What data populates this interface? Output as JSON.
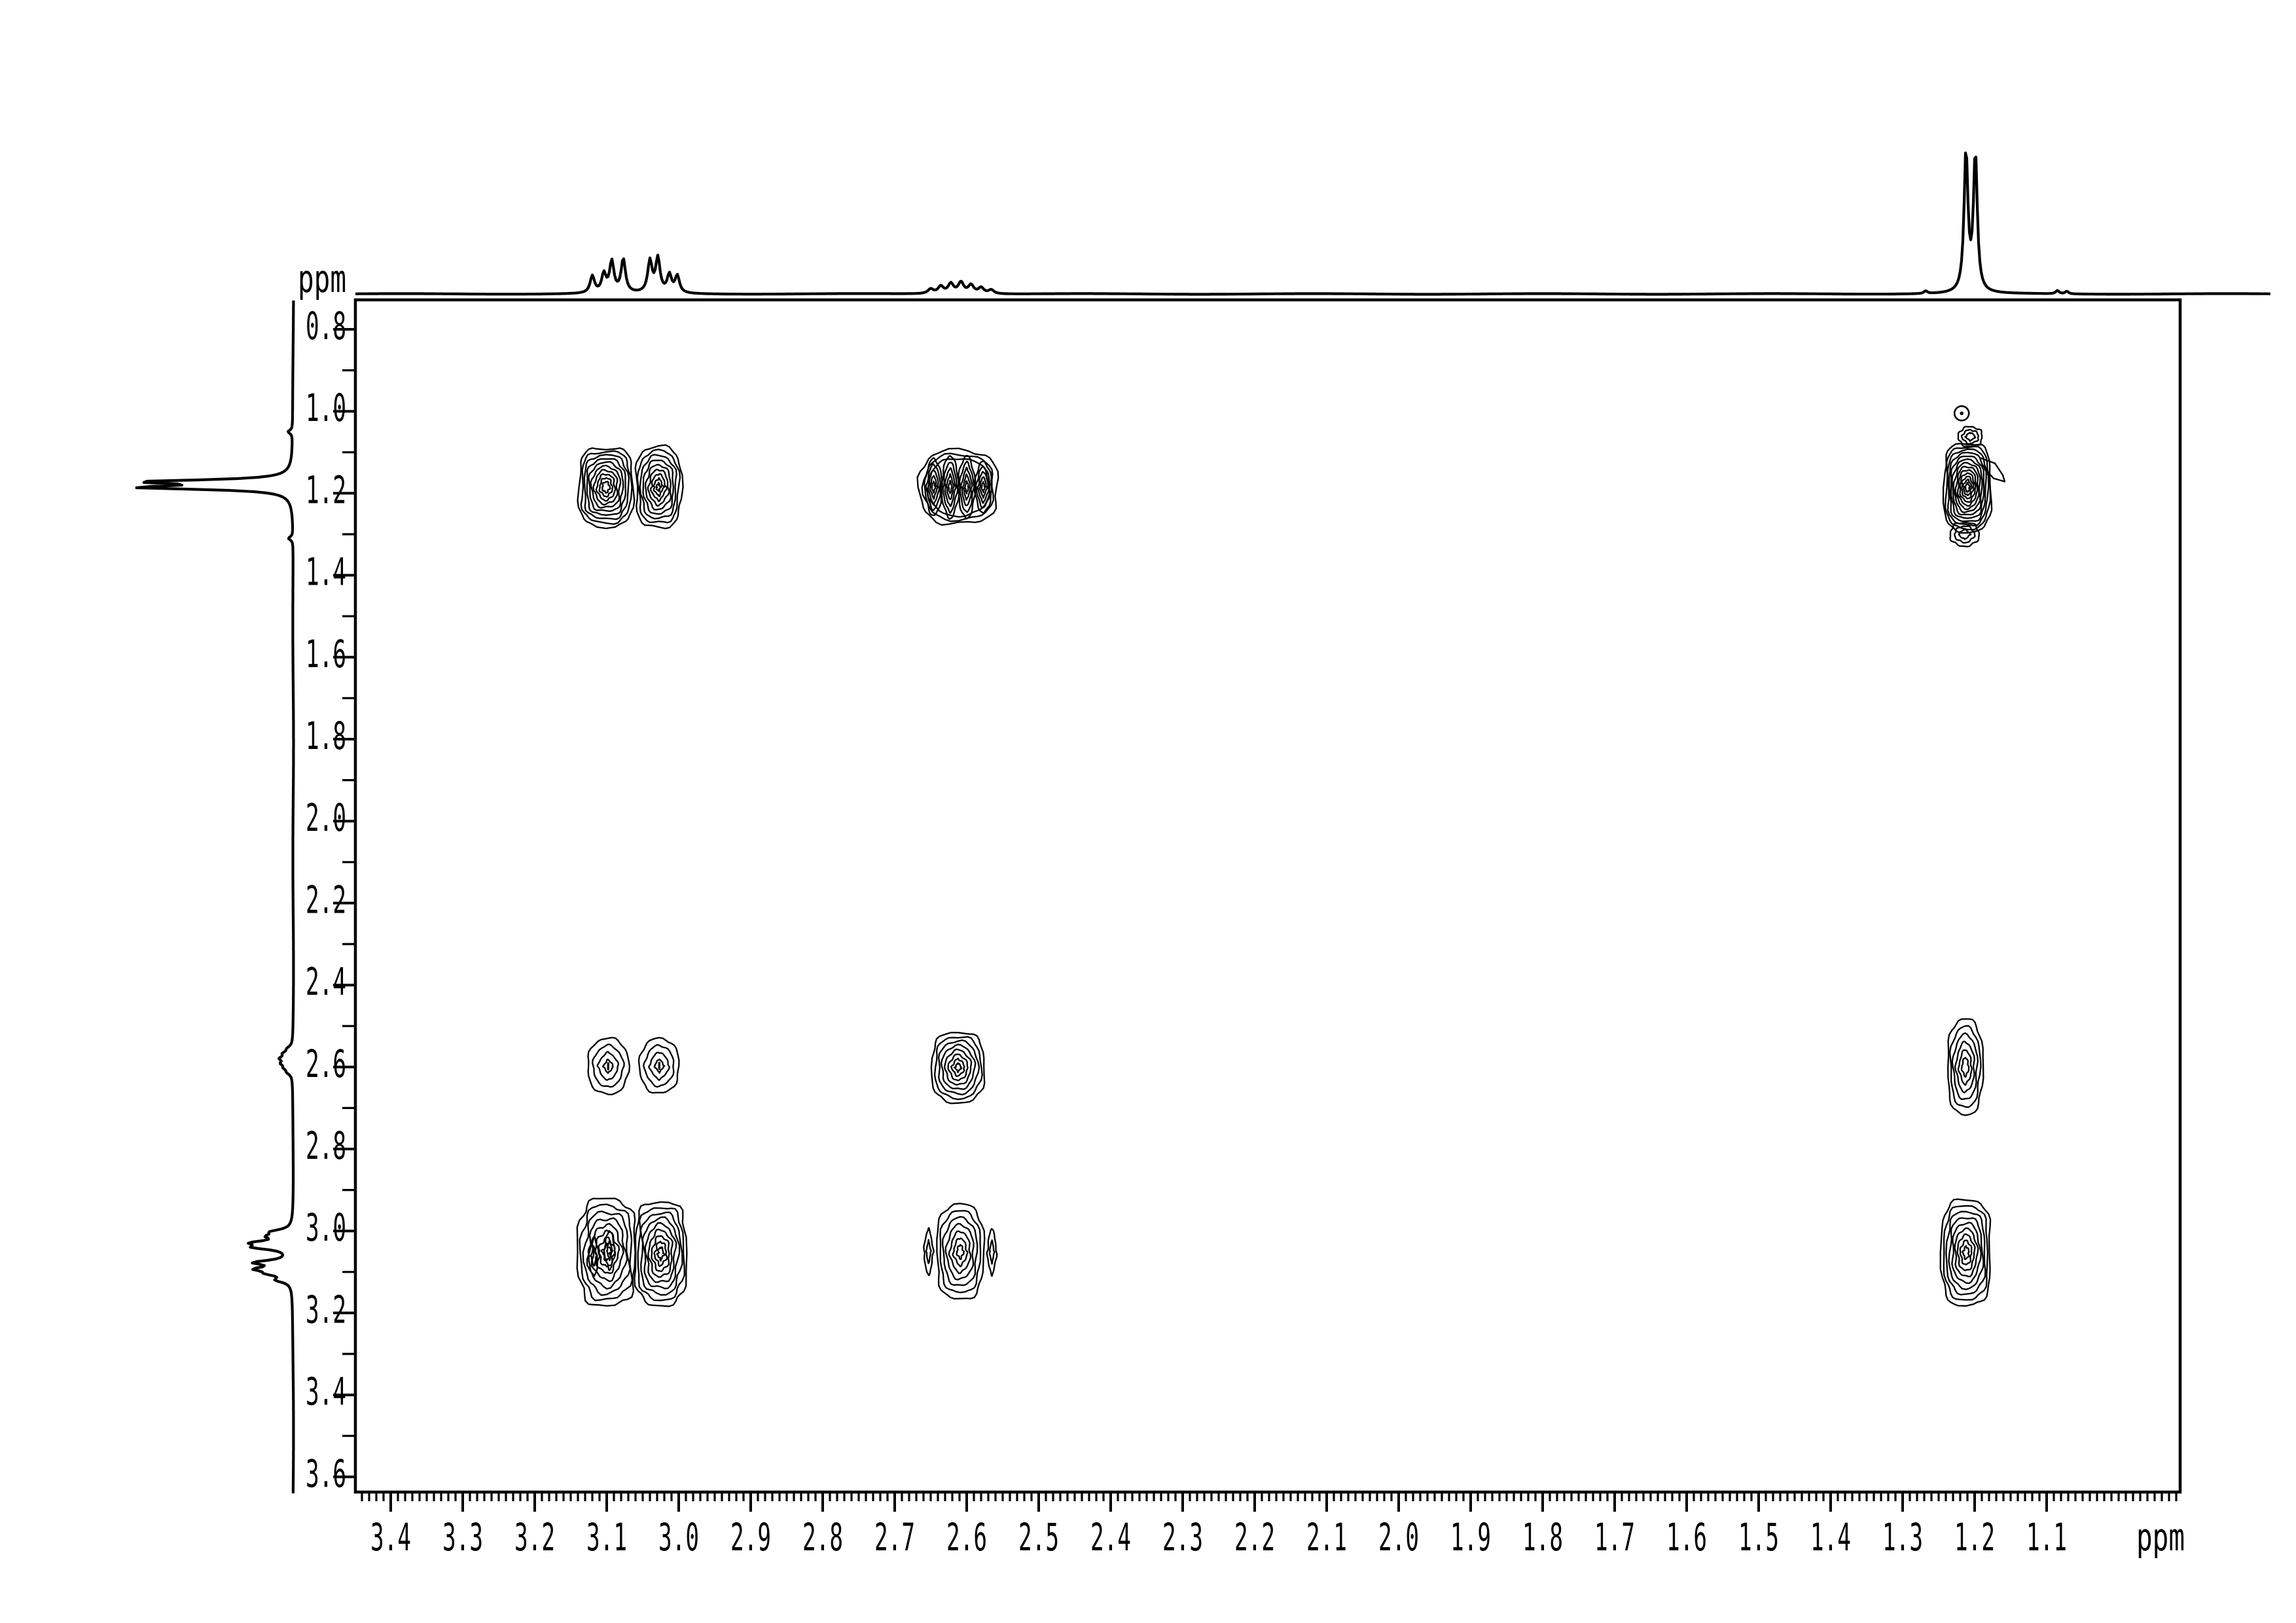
{
  "figure": {
    "background_color": "#ffffff",
    "line_color": "#000000"
  },
  "chart_data": {
    "type": "contour",
    "subtype": "2D NMR correlation spectrum (COSY) with 1D proton projections on top and left",
    "axes": {
      "x": {
        "unit_label": "ppm",
        "direction": "values decrease to the right",
        "range_ppm": [
          3.45,
          0.91
        ],
        "major_tick_step_ppm": 0.1,
        "minor_tick_step_ppm": 0.01,
        "tick_labels": [
          "3.4",
          "3.3",
          "3.2",
          "3.1",
          "3.0",
          "2.9",
          "2.8",
          "2.7",
          "2.6",
          "2.5",
          "2.4",
          "2.3",
          "2.2",
          "2.1",
          "2.0",
          "1.9",
          "1.8",
          "1.7",
          "1.6",
          "1.5",
          "1.4",
          "1.3",
          "1.2",
          "1.1"
        ]
      },
      "y": {
        "unit_label": "ppm",
        "direction": "values increase downward",
        "range_ppm": [
          0.73,
          3.64
        ],
        "major_tick_step_ppm": 0.2,
        "minor_tick_step_ppm": 0.1,
        "tick_labels": [
          "0.8",
          "1.0",
          "1.2",
          "1.4",
          "1.6",
          "1.8",
          "2.0",
          "2.2",
          "2.4",
          "2.6",
          "2.8",
          "3.0",
          "3.2",
          "3.4",
          "3.6"
        ]
      }
    },
    "top_projection_peaks": [
      [
        3.12,
        26,
        4
      ],
      [
        3.104,
        28,
        4
      ],
      [
        3.093,
        47,
        4
      ],
      [
        3.077,
        51,
        4
      ],
      [
        3.04,
        48,
        4
      ],
      [
        3.029,
        52,
        4
      ],
      [
        3.013,
        27,
        4
      ],
      [
        3.002,
        26,
        4
      ],
      [
        2.65,
        7,
        5
      ],
      [
        2.636,
        11,
        5
      ],
      [
        2.622,
        15,
        5
      ],
      [
        2.608,
        17,
        5
      ],
      [
        2.594,
        13,
        5
      ],
      [
        2.58,
        9,
        5
      ],
      [
        2.566,
        6,
        5
      ],
      [
        1.212,
        215,
        3.5
      ],
      [
        1.199,
        211,
        3.5
      ],
      [
        1.268,
        4,
        3
      ],
      [
        1.085,
        5,
        3
      ],
      [
        1.072,
        4,
        3
      ]
    ],
    "left_projection_peaks": [
      [
        3.12,
        20,
        4
      ],
      [
        3.104,
        27,
        4
      ],
      [
        3.093,
        46,
        4
      ],
      [
        3.077,
        52,
        4
      ],
      [
        3.04,
        48,
        4
      ],
      [
        3.029,
        50,
        4
      ],
      [
        3.013,
        27,
        4
      ],
      [
        3.002,
        26,
        4
      ],
      [
        2.613,
        6,
        4
      ],
      [
        2.602,
        9,
        4
      ],
      [
        2.591,
        13,
        4
      ],
      [
        2.579,
        15,
        4
      ],
      [
        2.567,
        11,
        4
      ],
      [
        2.555,
        6,
        4
      ],
      [
        1.186,
        215,
        3.5
      ],
      [
        1.172,
        211,
        3.5
      ],
      [
        1.31,
        7,
        3
      ],
      [
        1.05,
        7,
        3
      ]
    ],
    "cross_peaks": [
      {
        "id": "crosspeak-3.10x1.19",
        "type": "simple",
        "f2": 3.101,
        "f1": 1.185,
        "w": 0.075,
        "h": 0.192,
        "n": 10,
        "p_outer": 3.4,
        "p_inner": 1.6,
        "jag": 3,
        "shrink": 0.86
      },
      {
        "id": "crosspeak-3.03x1.19",
        "type": "simple",
        "f2": 3.028,
        "f1": 1.185,
        "w": 0.063,
        "h": 0.198,
        "n": 9,
        "p_outer": 3.0,
        "p_inner": 1.1,
        "jag": 3,
        "shrink": 0.9
      },
      {
        "id": "crosspeak-2.61x1.19-quartet",
        "type": "cluster",
        "f2": 2.611,
        "f1": 1.185,
        "env_w": 0.109,
        "env_h": 0.18,
        "env_n": 3,
        "lobe_w": 0.024,
        "lobe_n": 5,
        "lobes": [
          [
            2.646,
            0.14
          ],
          [
            2.623,
            0.154
          ],
          [
            2.6,
            0.154
          ],
          [
            2.577,
            0.126
          ]
        ]
      },
      {
        "id": "diagonal-1.21x1.19",
        "type": "diagonal",
        "f2": 1.21,
        "f1": 1.186,
        "w": 0.065,
        "h": 0.216,
        "n": 13,
        "satellites": [
          [
            1.206,
            1.062,
            0.033,
            0.048
          ],
          [
            1.214,
            1.3,
            0.04,
            0.058
          ]
        ],
        "hook": true
      },
      {
        "id": "crosspeak-3.10x2.60",
        "type": "simple",
        "f2": 3.098,
        "f1": 2.598,
        "w": 0.057,
        "h": 0.137,
        "n": 4,
        "p_outer": 2.2,
        "p_inner": 1.15,
        "jag": 2,
        "shrink": 0.76,
        "dot": true
      },
      {
        "id": "crosspeak-3.03x2.60",
        "type": "simple",
        "f2": 3.027,
        "f1": 2.597,
        "w": 0.055,
        "h": 0.134,
        "n": 4,
        "p_outer": 2.2,
        "p_inner": 1.15,
        "jag": 2,
        "shrink": 0.76,
        "dot": true
      },
      {
        "id": "diagonal-2.61x2.60",
        "type": "simple",
        "f2": 2.612,
        "f1": 2.601,
        "w": 0.073,
        "h": 0.172,
        "n": 8,
        "p_outer": 2.8,
        "p_inner": 1.15,
        "jag": 2.5,
        "shrink": 0.88
      },
      {
        "id": "crosspeak-1.21x2.60",
        "type": "simple",
        "f2": 1.213,
        "f1": 2.6,
        "w": 0.049,
        "h": 0.235,
        "n": 6,
        "p_outer": 2.5,
        "p_inner": 1.4,
        "jag": 2.5,
        "shrink": 0.8
      },
      {
        "id": "crosspeak-3.10x3.05",
        "type": "simple",
        "f2": 3.1,
        "f1": 3.052,
        "w": 0.08,
        "h": 0.262,
        "n": 8,
        "p_outer": 3.0,
        "p_inner": 1.3,
        "jag": 5,
        "shrink": 0.85,
        "inner_lenses": [
          [
            -0.018,
            0.01
          ],
          [
            0.004,
            -0.005
          ]
        ]
      },
      {
        "id": "diagonal-3.03x3.05",
        "type": "simple",
        "f2": 3.025,
        "f1": 3.055,
        "w": 0.071,
        "h": 0.253,
        "n": 9,
        "p_outer": 3.2,
        "p_inner": 1.4,
        "jag": 4,
        "shrink": 0.88
      },
      {
        "id": "crosspeak-2.61x3.05",
        "type": "simple",
        "f2": 2.609,
        "f1": 3.051,
        "w": 0.065,
        "h": 0.232,
        "n": 7,
        "p_outer": 2.8,
        "p_inner": 1.3,
        "jag": 3,
        "shrink": 0.85,
        "wings": 0.044,
        "wing_h": 0.115
      },
      {
        "id": "crosspeak-1.21x3.05",
        "type": "simple",
        "f2": 1.212,
        "f1": 3.053,
        "w": 0.068,
        "h": 0.258,
        "n": 9,
        "p_outer": 3.2,
        "p_inner": 1.5,
        "jag": 3,
        "shrink": 0.88
      }
    ],
    "artifact_marker": {
      "f2_ppm": 1.218,
      "f1_ppm": 1.005,
      "shape": "small circle with center dot"
    }
  }
}
